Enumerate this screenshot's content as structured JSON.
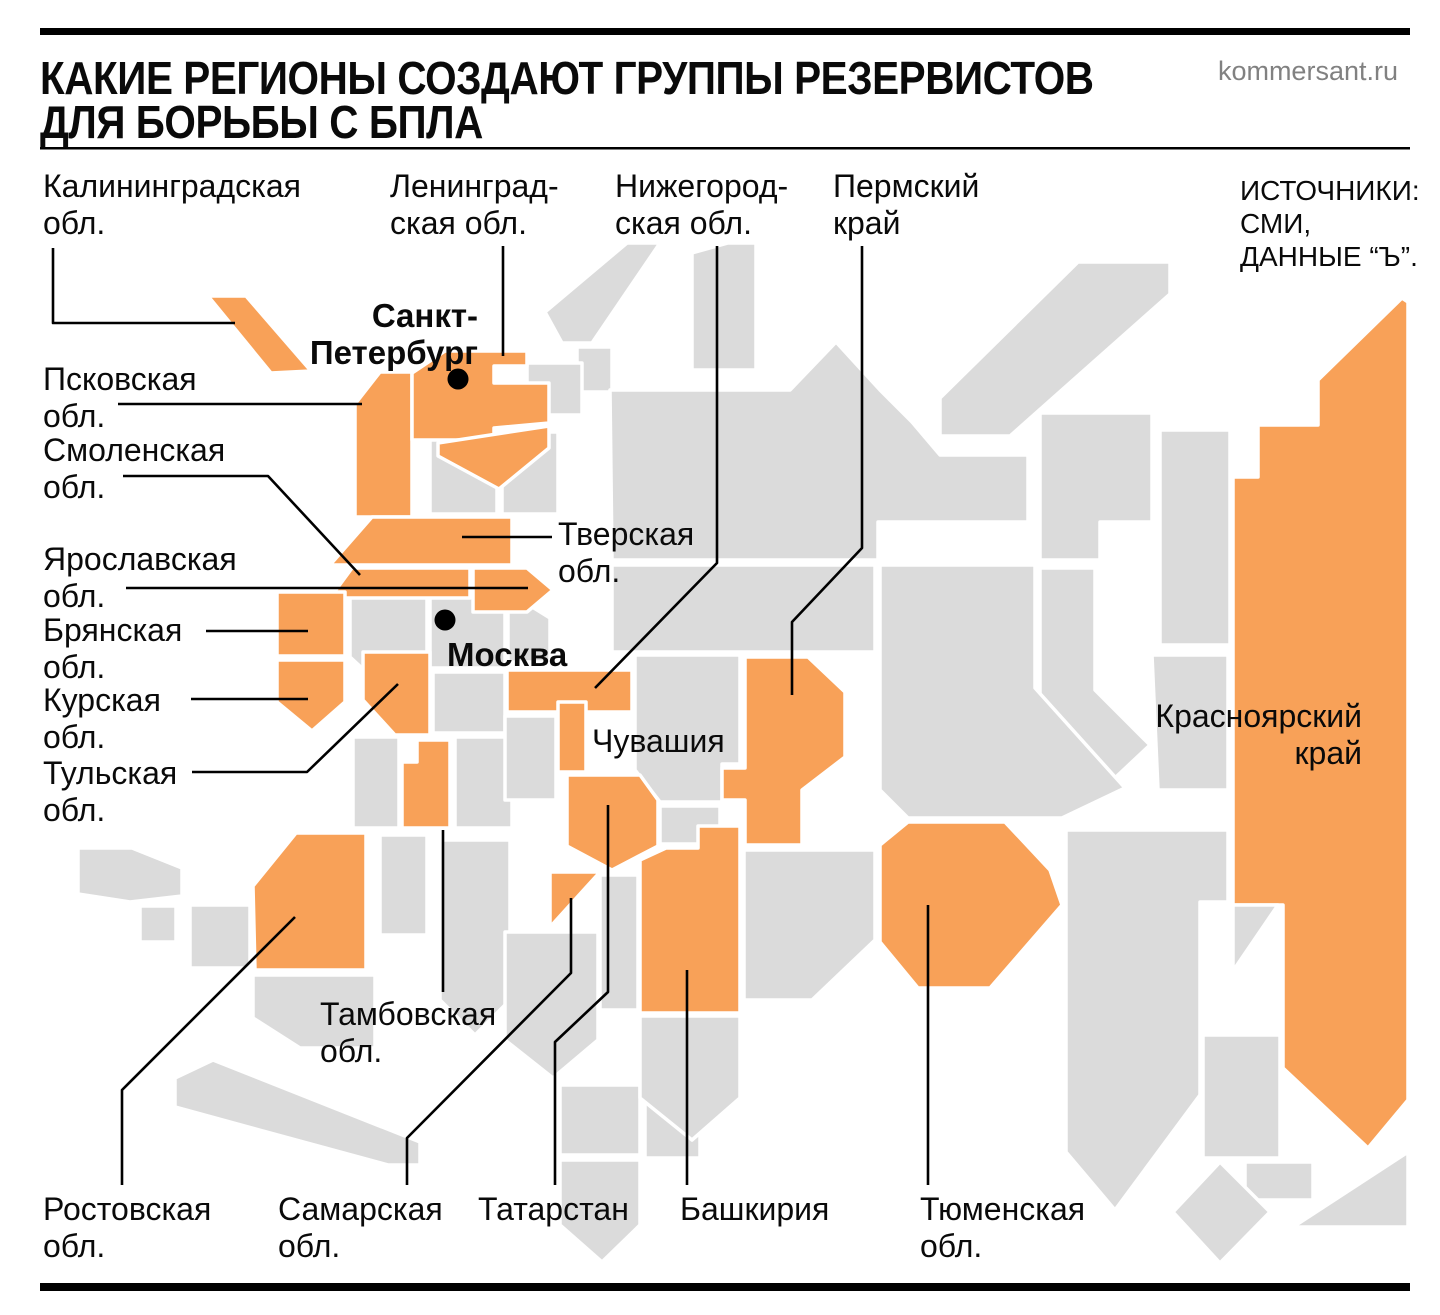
{
  "colors": {
    "highlight": "#f8a158",
    "base": "#dbdbdb",
    "line": "#000000",
    "muted": "#818181",
    "text": "#0a0a0a",
    "background": "#ffffff"
  },
  "header": {
    "title_line1": "КАКИЕ РЕГИОНЫ СОЗДАЮТ ГРУППЫ РЕЗЕРВИСТОВ",
    "title_line2": "ДЛЯ БОРЬБЫ С БПЛА",
    "site": "kommersant.ru"
  },
  "sources": {
    "line1": "ИСТОЧНИКИ:",
    "line2": "СМИ,",
    "line3": "ДАННЫЕ “Ъ”."
  },
  "cities": {
    "spb": {
      "line1": "Санкт-",
      "line2": "Петербург"
    },
    "moscow": {
      "name": "Москва"
    }
  },
  "labels": {
    "kaliningrad": {
      "line1": "Калининградская",
      "line2": "обл."
    },
    "leningrad": {
      "line1": "Ленинград-",
      "line2": "ская обл."
    },
    "nizhny": {
      "line1": "Нижегород-",
      "line2": "ская обл."
    },
    "perm": {
      "line1": "Пермский",
      "line2": "край"
    },
    "pskov": {
      "line1": "Псковская",
      "line2": "обл."
    },
    "smolensk": {
      "line1": "Смоленская",
      "line2": "обл."
    },
    "yaroslavl": {
      "line1": "Ярославская",
      "line2": "обл."
    },
    "bryansk": {
      "line1": "Брянская",
      "line2": "обл."
    },
    "kursk": {
      "line1": "Курская",
      "line2": "обл."
    },
    "tula": {
      "line1": "Тульская",
      "line2": "обл."
    },
    "tver": {
      "line1": "Тверская",
      "line2": "обл."
    },
    "chuvashia": {
      "line1": "Чувашия"
    },
    "tambov": {
      "line1": "Тамбовская",
      "line2": "обл."
    },
    "rostov": {
      "line1": "Ростовская",
      "line2": "обл."
    },
    "samara": {
      "line1": "Самарская",
      "line2": "обл."
    },
    "tatarstan": {
      "line1": "Татарстан"
    },
    "bashkiria": {
      "line1": "Башкирия"
    },
    "tyumen": {
      "line1": "Тюменская",
      "line2": "обл."
    },
    "krasnoyarsk": {
      "line1": "Красноярский",
      "line2": "край"
    }
  },
  "highlighted_regions": [
    "Калининградская обл.",
    "Ленинградская обл.",
    "Санкт-Петербург",
    "Псковская обл.",
    "Смоленская обл.",
    "Тверская обл.",
    "Ярославская обл.",
    "Брянская обл.",
    "Курская обл.",
    "Тульская обл.",
    "Нижегородская обл.",
    "Чувашия",
    "Тамбовская обл.",
    "Ростовская обл.",
    "Самарская обл.",
    "Татарстан",
    "Башкирия",
    "Пермский край",
    "Тюменская обл.",
    "Красноярский край"
  ]
}
